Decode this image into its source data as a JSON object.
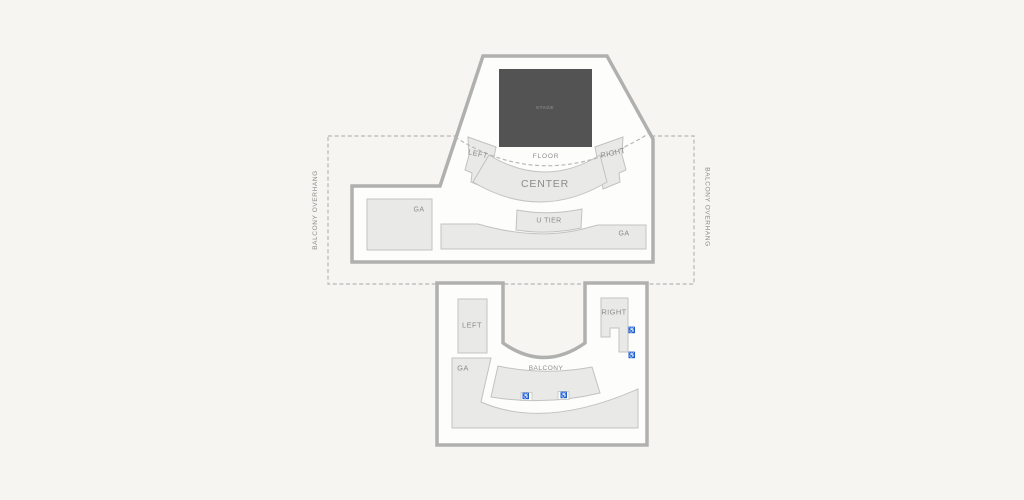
{
  "colors": {
    "background": "#f6f5f2",
    "venueFill": "#fdfdfb",
    "wall": "#b0b0ae",
    "sectionFill": "#e9e9e7",
    "sectionBorder": "#c2c2c0",
    "stageFill": "#535353",
    "stageText": "#9c9c9c",
    "labelText": "#8b8b89",
    "dashedLine": "#b8b8b6",
    "accessibleIcon": "#b5b5b3"
  },
  "stage": {
    "label": "STAGE"
  },
  "main_level": {
    "floor_label": "FLOOR",
    "left_label": "LEFT",
    "right_label": "RIGHT",
    "center_label": "CENTER",
    "u_tier_label": "U TIER",
    "ga_west_label": "GA",
    "ga_east_label": "GA"
  },
  "balcony_level": {
    "left_label": "LEFT",
    "right_label": "RIGHT",
    "ga_label": "GA",
    "balcony_label": "BALCONY"
  },
  "overhang": {
    "left_label": "BALCONY OVERHANG",
    "right_label": "BALCONY OVERHANG"
  },
  "icons": {
    "wheelchair": "♿"
  }
}
